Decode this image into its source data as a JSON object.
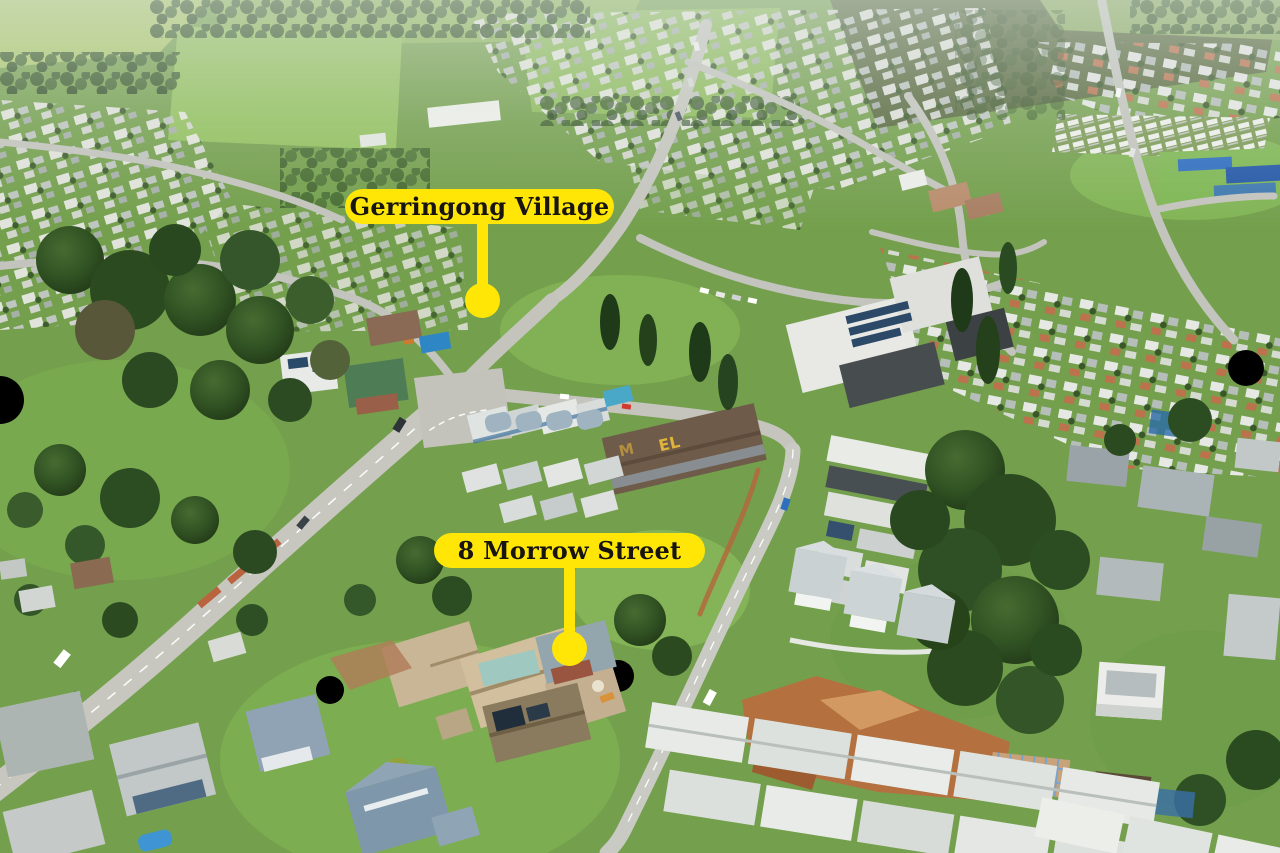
{
  "image_type": "aerial-photograph",
  "markers": [
    {
      "label": "Gerringong Village"
    },
    {
      "label": "8 Morrow Street"
    }
  ],
  "rooftop_sign": {
    "visible_letters": [
      "M",
      "EL"
    ]
  },
  "colors": {
    "marker_background": "#ffe606",
    "marker_text": "#181410"
  }
}
